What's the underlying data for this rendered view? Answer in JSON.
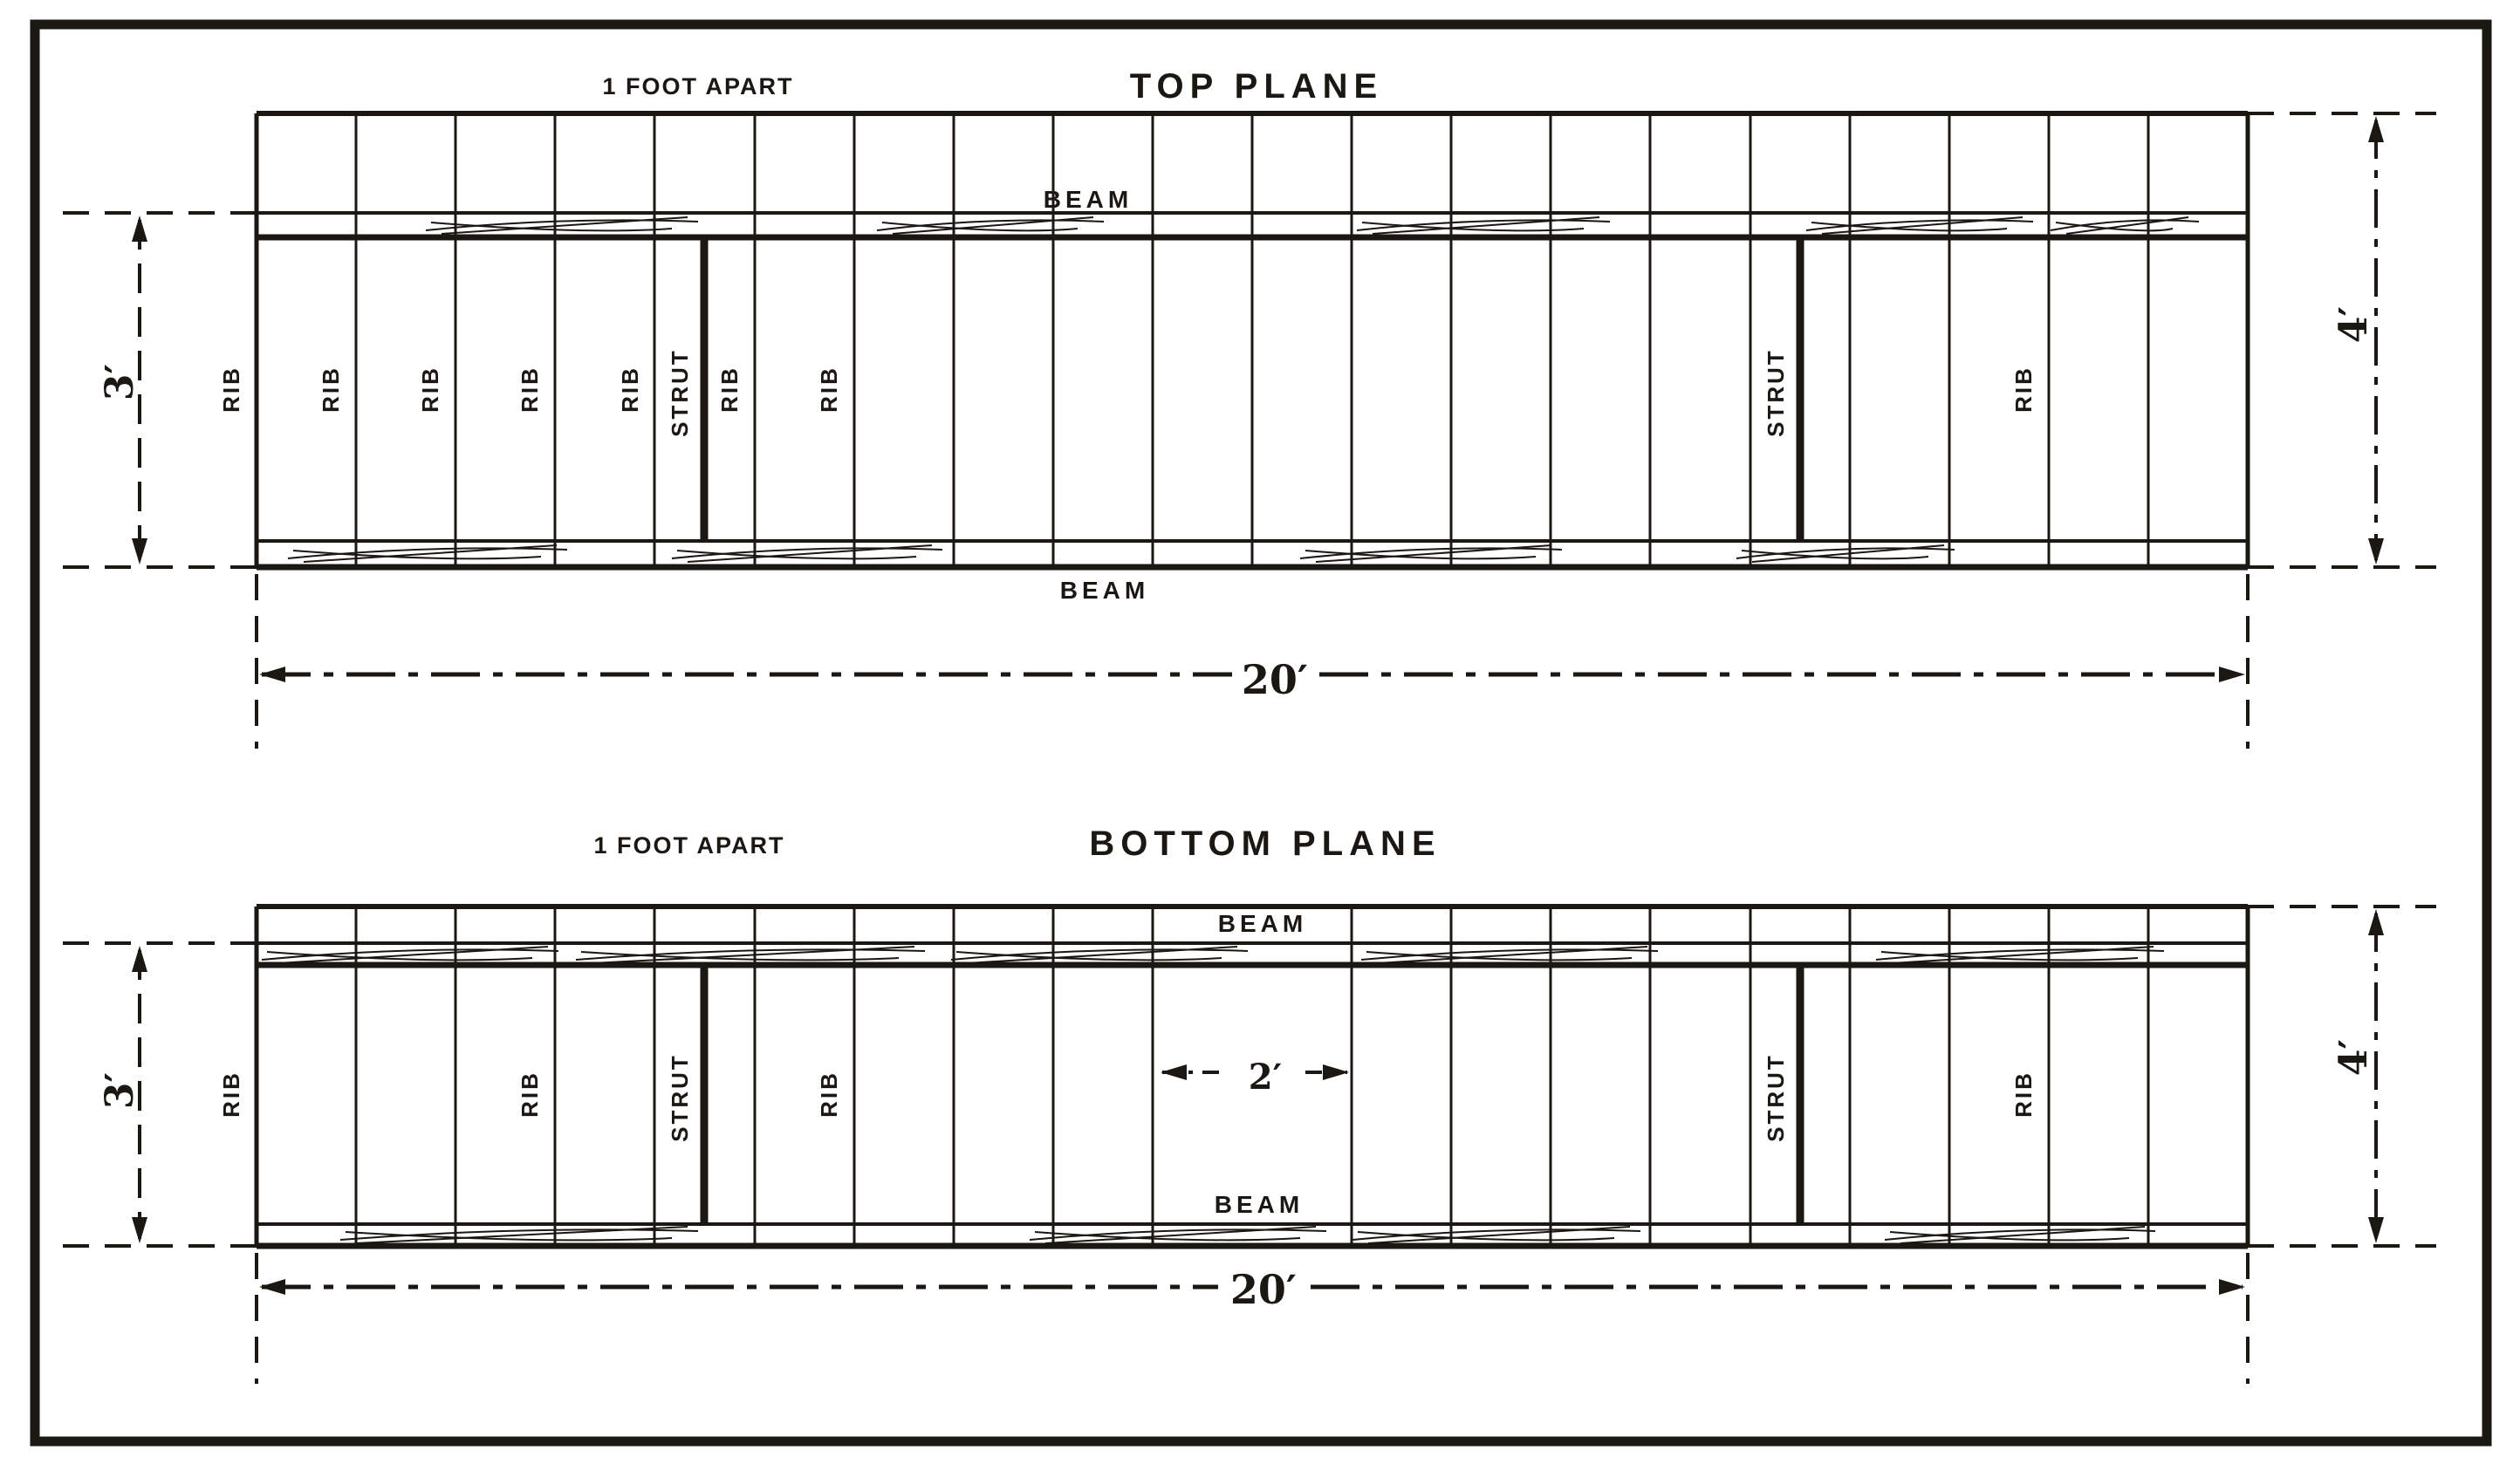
{
  "colors": {
    "ink": "#1b1712",
    "paper": "#ffffff"
  },
  "top_plane": {
    "title": "TOP PLANE",
    "spacing_note": "1 FOOT APART",
    "beam_label": "BEAM",
    "rib_label": "RIB",
    "strut_label": "STRUT",
    "dims": {
      "span": "20′",
      "depth": "3′",
      "chord": "4′"
    }
  },
  "bottom_plane": {
    "title": "BOTTOM PLANE",
    "spacing_note": "1 FOOT APART",
    "beam_label": "BEAM",
    "rib_label": "RIB",
    "strut_label": "STRUT",
    "dims": {
      "span": "20′",
      "depth": "3′",
      "chord": "4′",
      "bay": "2′"
    }
  }
}
